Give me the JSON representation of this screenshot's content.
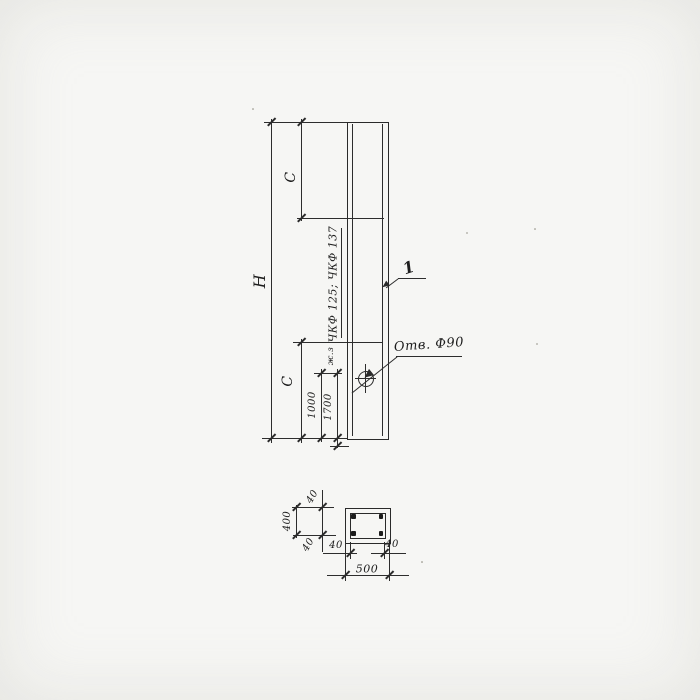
{
  "colors": {
    "ink": "#2d2d2d",
    "paper": "#f6f6f4"
  },
  "drawing": {
    "elevation": {
      "height_label": "H",
      "c_top_label": "C",
      "c_bottom_label": "C",
      "dim_1000": "1000",
      "dim_1700": "1700",
      "series_text": "ЧКФ 125; ЧКФ 137",
      "mark_text": "ж.з",
      "hole_label": "Отв. Ф90",
      "position_label": "1"
    },
    "section": {
      "width_label": "500",
      "height_label": "400",
      "cover_top": "40",
      "cover_bottom": "40",
      "cover_left": "40",
      "cover_right": "40"
    }
  }
}
